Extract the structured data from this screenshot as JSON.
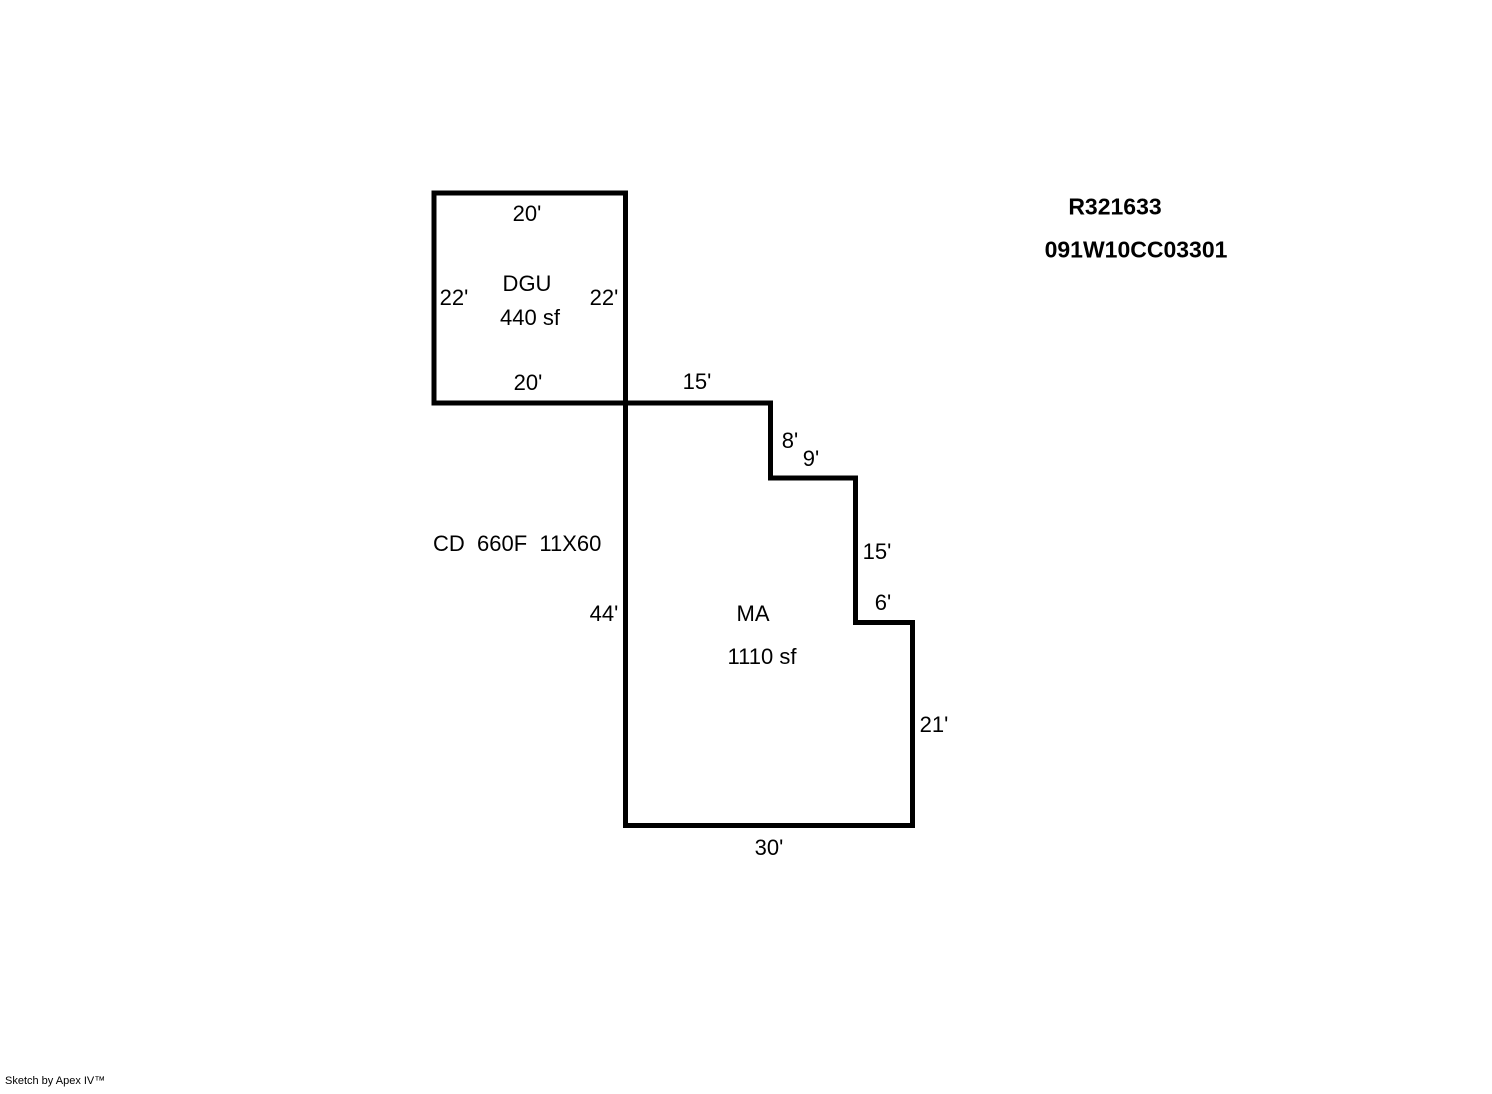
{
  "title_block": {
    "record_id": "R321633",
    "parcel_id": "091W10CC03301"
  },
  "annotation": {
    "code_line": "CD  660F  11X60"
  },
  "footer": {
    "credit": "Sketch by Apex IV™"
  },
  "colors": {
    "background": "#ffffff",
    "line": "#000000",
    "text": "#000000"
  },
  "sections": {
    "dgu": {
      "label": "DGU",
      "area": "440 sf",
      "dim_top": "20'",
      "dim_left": "22'",
      "dim_right": "22'",
      "dim_bottom": "20'"
    },
    "ma": {
      "label": "MA",
      "area": "1110 sf",
      "dim_top": "15'",
      "dim_step_8": "8'",
      "dim_step_9": "9'",
      "dim_step_15": "15'",
      "dim_step_6": "6'",
      "dim_left": "44'",
      "dim_right": "21'",
      "dim_bottom": "30'"
    }
  }
}
